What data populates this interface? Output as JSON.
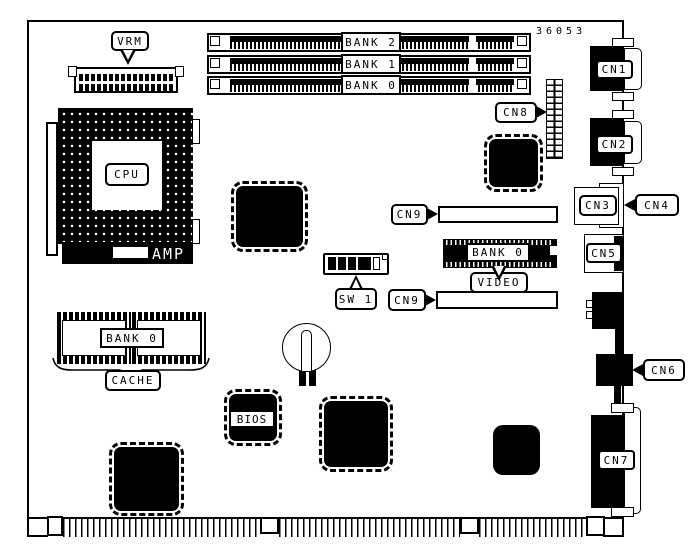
{
  "diagram": {
    "title": "motherboard component location diagram",
    "part_number": "36053",
    "colors": {
      "background": "#ffffff",
      "line": "#000000",
      "chip_fill": "#000000"
    },
    "labels": {
      "vrm": "VRM",
      "cpu": "CPU",
      "amp": "AMP",
      "simm_banks": [
        "BANK 2",
        "BANK 1",
        "BANK 0"
      ],
      "cn1": "CN1",
      "cn2": "CN2",
      "cn3": "CN3",
      "cn4": "CN4",
      "cn5": "CN5",
      "cn6": "CN6",
      "cn7": "CN7",
      "cn8": "CN8",
      "cn9_top": "CN9",
      "cn9_bottom": "CN9",
      "video_bank": "BANK 0",
      "video": "VIDEO",
      "sw1": "SW 1",
      "cache_bank": "BANK 0",
      "cache": "CACHE",
      "bios": "BIOS"
    }
  }
}
